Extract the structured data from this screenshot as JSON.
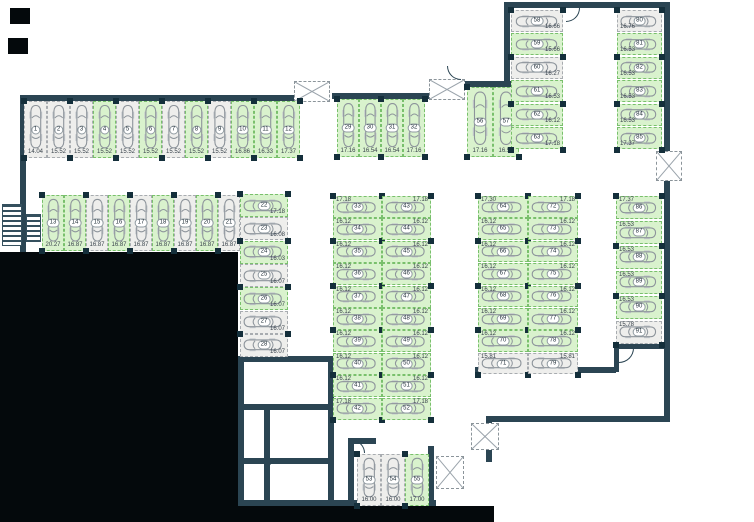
{
  "meta": {
    "canvas_w": 754,
    "canvas_h": 522,
    "view": "parking-garage-floor-plan"
  },
  "colors": {
    "wall": "#2b4553",
    "column": "#142f3b",
    "free_fill": "#d9f2cd",
    "free_border": "#79c06c",
    "taken_fill": "#eeeeec",
    "taken_border": "#a8acb0",
    "car_outline": "#8d949b",
    "label_text": "#39434c",
    "void": "#04090c"
  },
  "blocks": [
    {
      "id": "top-left-row",
      "car": "v",
      "label": "b",
      "pillars": "a",
      "x": 24,
      "y": 101,
      "dx": 23,
      "dy": 0,
      "w": 23,
      "h": 57,
      "spaces": [
        {
          "n": "1",
          "area": "14.04",
          "state": "taken"
        },
        {
          "n": "2",
          "area": "15.52",
          "state": "taken"
        },
        {
          "n": "3",
          "area": "15.52",
          "state": "taken"
        },
        {
          "n": "4",
          "area": "15.52",
          "state": "free"
        },
        {
          "n": "5",
          "area": "15.52",
          "state": "taken"
        },
        {
          "n": "6",
          "area": "15.52",
          "state": "free"
        },
        {
          "n": "7",
          "area": "15.52",
          "state": "taken"
        },
        {
          "n": "8",
          "area": "15.52",
          "state": "free"
        },
        {
          "n": "9",
          "area": "15.52",
          "state": "taken"
        },
        {
          "n": "10",
          "area": "16.86",
          "state": "free"
        },
        {
          "n": "11",
          "area": "16.33",
          "state": "free"
        },
        {
          "n": "12",
          "area": "17.37",
          "state": "free"
        }
      ]
    },
    {
      "id": "second-row",
      "car": "v",
      "label": "b",
      "pillars": "a",
      "x": 42,
      "y": 195,
      "dx": 22,
      "dy": 0,
      "w": 22,
      "h": 56,
      "spaces": [
        {
          "n": "13",
          "area": "20.27",
          "state": "free"
        },
        {
          "n": "14",
          "area": "16.87",
          "state": "free"
        },
        {
          "n": "15",
          "area": "16.87",
          "state": "taken"
        },
        {
          "n": "16",
          "area": "16.87",
          "state": "free"
        },
        {
          "n": "17",
          "area": "16.87",
          "state": "taken"
        },
        {
          "n": "18",
          "area": "16.87",
          "state": "free"
        },
        {
          "n": "19",
          "area": "16.87",
          "state": "taken"
        },
        {
          "n": "20",
          "area": "16.87",
          "state": "free"
        },
        {
          "n": "21",
          "area": "16.87",
          "state": "taken"
        }
      ]
    },
    {
      "id": "east-col-22-28",
      "car": "h",
      "label": "br",
      "pillars": "a",
      "x": 240,
      "y": 194,
      "dx": 0,
      "dy": 23.3,
      "w": 48,
      "h": 23,
      "spaces": [
        {
          "n": "22",
          "area": "17.18",
          "state": "free"
        },
        {
          "n": "23",
          "area": "16.08",
          "state": "taken"
        },
        {
          "n": "24",
          "area": "16.03",
          "state": "free"
        },
        {
          "n": "25",
          "area": "16.07",
          "state": "taken"
        },
        {
          "n": "26",
          "area": "16.07",
          "state": "free"
        },
        {
          "n": "27",
          "area": "16.07",
          "state": "taken"
        },
        {
          "n": "28",
          "area": "16.07",
          "state": "taken"
        }
      ]
    },
    {
      "id": "mid-top-row",
      "car": "v",
      "label": "b",
      "pillars": "a",
      "x": 337,
      "y": 99,
      "dx": 22,
      "dy": 0,
      "w": 22,
      "h": 58,
      "spaces": [
        {
          "n": "29",
          "area": "17.16",
          "state": "free"
        },
        {
          "n": "30",
          "area": "16.54",
          "state": "free"
        },
        {
          "n": "31",
          "area": "16.54",
          "state": "free"
        },
        {
          "n": "32",
          "area": "17.16",
          "state": "free"
        }
      ]
    },
    {
      "id": "mid-col-west",
      "car": "h",
      "label": "tl",
      "pillars": "a",
      "x": 333,
      "y": 196,
      "dx": 0,
      "dy": 22.4,
      "w": 49,
      "h": 22,
      "spaces": [
        {
          "n": "33",
          "area": "17.18",
          "state": "free"
        },
        {
          "n": "34",
          "area": "16.12",
          "state": "free"
        },
        {
          "n": "35",
          "area": "16.12",
          "state": "free"
        },
        {
          "n": "36",
          "area": "16.12",
          "state": "free"
        },
        {
          "n": "37",
          "area": "16.12",
          "state": "free"
        },
        {
          "n": "38",
          "area": "16.12",
          "state": "free"
        },
        {
          "n": "39",
          "area": "16.12",
          "state": "free"
        },
        {
          "n": "40",
          "area": "16.12",
          "state": "free"
        },
        {
          "n": "41",
          "area": "16.12",
          "state": "free"
        },
        {
          "n": "42",
          "area": "17.18",
          "state": "free"
        }
      ]
    },
    {
      "id": "mid-col-east",
      "car": "h",
      "label": "tr",
      "pillars": "r",
      "x": 382,
      "y": 196,
      "dx": 0,
      "dy": 22.4,
      "w": 49,
      "h": 22,
      "spaces": [
        {
          "n": "43",
          "area": "17.18",
          "state": "free"
        },
        {
          "n": "44",
          "area": "16.12",
          "state": "free"
        },
        {
          "n": "45",
          "area": "16.12",
          "state": "free"
        },
        {
          "n": "46",
          "area": "16.12",
          "state": "free"
        },
        {
          "n": "47",
          "area": "16.12",
          "state": "free"
        },
        {
          "n": "48",
          "area": "16.12",
          "state": "free"
        },
        {
          "n": "49",
          "area": "16.12",
          "state": "free"
        },
        {
          "n": "50",
          "area": "16.12",
          "state": "free"
        },
        {
          "n": "51",
          "area": "16.12",
          "state": "free"
        },
        {
          "n": "52",
          "area": "17.18",
          "state": "free"
        }
      ]
    },
    {
      "id": "south-row-53-55",
      "car": "v",
      "label": "b",
      "pillars": "a",
      "x": 357,
      "y": 454,
      "dx": 24,
      "dy": 0,
      "w": 24,
      "h": 52,
      "spaces": [
        {
          "n": "53",
          "area": "16.00",
          "state": "taken"
        },
        {
          "n": "54",
          "area": "16.00",
          "state": "taken"
        },
        {
          "n": "55",
          "area": "17.00",
          "state": "free"
        }
      ]
    },
    {
      "id": "row-56-57",
      "car": "v",
      "label": "b",
      "pillars": "a",
      "x": 467,
      "y": 87,
      "dx": 26,
      "dy": 0,
      "w": 26,
      "h": 70,
      "spaces": [
        {
          "n": "56",
          "area": "17.16",
          "state": "free"
        },
        {
          "n": "57",
          "area": "16.54",
          "state": "free"
        }
      ]
    },
    {
      "id": "ne-col-west",
      "car": "h",
      "label": "br",
      "pillars": "a",
      "x": 511,
      "y": 10,
      "dx": 0,
      "dy": 23.4,
      "w": 52,
      "h": 22,
      "spaces": [
        {
          "n": "58",
          "area": "16.66",
          "state": "taken"
        },
        {
          "n": "59",
          "area": "15.66",
          "state": "free"
        },
        {
          "n": "60",
          "area": "16.27",
          "state": "taken"
        },
        {
          "n": "61",
          "area": "16.53",
          "state": "free"
        },
        {
          "n": "62",
          "area": "16.12",
          "state": "free"
        },
        {
          "n": "63",
          "area": "17.18",
          "state": "free"
        }
      ]
    },
    {
      "id": "ne-col-east",
      "car": "h",
      "label": "bl",
      "pillars": "a",
      "x": 617,
      "y": 10,
      "dx": 0,
      "dy": 23.4,
      "w": 45,
      "h": 22,
      "spaces": [
        {
          "n": "80",
          "area": "16.76",
          "state": "taken"
        },
        {
          "n": "81",
          "area": "16.53",
          "state": "free"
        },
        {
          "n": "82",
          "area": "16.53",
          "state": "free"
        },
        {
          "n": "83",
          "area": "16.53",
          "state": "free"
        },
        {
          "n": "84",
          "area": "16.53",
          "state": "free"
        },
        {
          "n": "85",
          "area": "17.37",
          "state": "free"
        }
      ]
    },
    {
      "id": "east-mid-col-west",
      "car": "h",
      "label": "tl",
      "pillars": "a",
      "x": 478,
      "y": 196,
      "dx": 0,
      "dy": 22.4,
      "w": 50,
      "h": 21.5,
      "spaces": [
        {
          "n": "64",
          "area": "17.30",
          "state": "free"
        },
        {
          "n": "65",
          "area": "16.12",
          "state": "free"
        },
        {
          "n": "66",
          "area": "16.12",
          "state": "free"
        },
        {
          "n": "67",
          "area": "16.12",
          "state": "free"
        },
        {
          "n": "68",
          "area": "16.12",
          "state": "free"
        },
        {
          "n": "69",
          "area": "16.12",
          "state": "free"
        },
        {
          "n": "70",
          "area": "16.12",
          "state": "free"
        },
        {
          "n": "71",
          "area": "15.81",
          "state": "taken"
        }
      ]
    },
    {
      "id": "east-mid-col-east",
      "car": "h",
      "label": "tr",
      "pillars": "r",
      "x": 528,
      "y": 196,
      "dx": 0,
      "dy": 22.4,
      "w": 50,
      "h": 21.5,
      "spaces": [
        {
          "n": "72",
          "area": "17.18",
          "state": "free"
        },
        {
          "n": "73",
          "area": "16.12",
          "state": "free"
        },
        {
          "n": "74",
          "area": "16.12",
          "state": "free"
        },
        {
          "n": "75",
          "area": "16.12",
          "state": "free"
        },
        {
          "n": "76",
          "area": "16.12",
          "state": "free"
        },
        {
          "n": "77",
          "area": "16.12",
          "state": "free"
        },
        {
          "n": "78",
          "area": "16.12",
          "state": "free"
        },
        {
          "n": "79",
          "area": "15.81",
          "state": "taken"
        }
      ]
    },
    {
      "id": "far-east-col",
      "car": "h",
      "label": "tl",
      "pillars": "a",
      "x": 616,
      "y": 196,
      "dx": 0,
      "dy": 24.9,
      "w": 46,
      "h": 23,
      "spaces": [
        {
          "n": "86",
          "area": "17.37",
          "state": "free"
        },
        {
          "n": "87",
          "area": "16.53",
          "state": "free"
        },
        {
          "n": "88",
          "area": "16.53",
          "state": "free"
        },
        {
          "n": "89",
          "area": "16.53",
          "state": "free"
        },
        {
          "n": "90",
          "area": "16.53",
          "state": "free"
        },
        {
          "n": "91",
          "area": "15.78",
          "state": "taken"
        }
      ]
    }
  ]
}
